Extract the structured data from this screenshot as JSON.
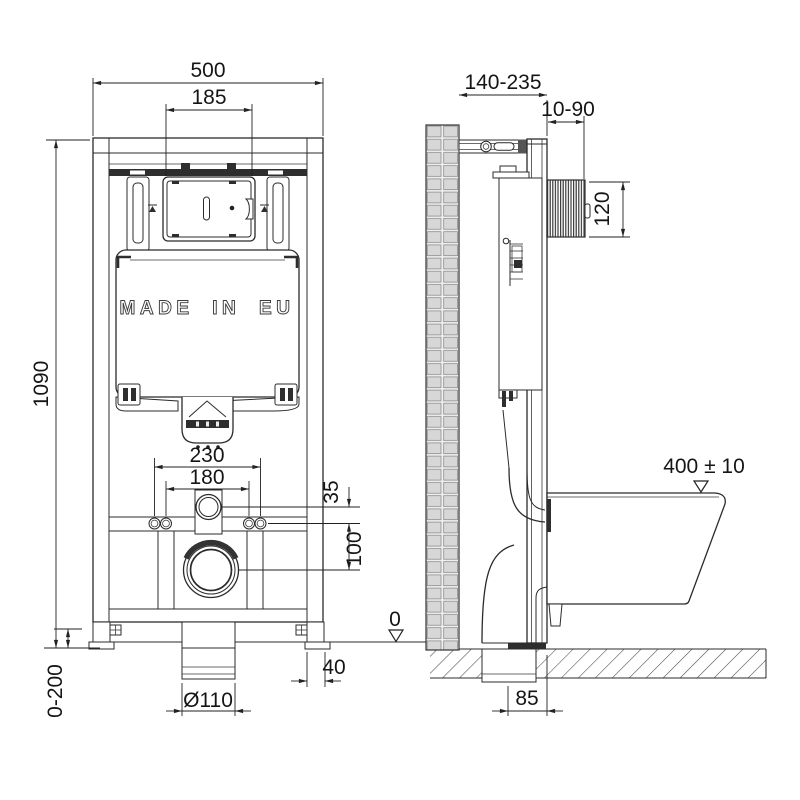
{
  "front_view": {
    "frame_width": "500",
    "cutout_width": "185",
    "frame_height": "1090",
    "fixing_spacing_outer": "230",
    "fixing_spacing_inner": "180",
    "inlet_offset": "35",
    "inlet_to_outlet": "100",
    "foot_width": "40",
    "foot_adjust_range": "0-200",
    "outlet_diameter": "Ø110",
    "made_in_label": "MADE IN EU"
  },
  "side_view": {
    "frame_depth_range": "140-235",
    "actuator_depth_range": "10-90",
    "actuator_height": "120",
    "bowl_top_height": "400 ± 10",
    "floor_datum": "0",
    "outlet_to_front": "85"
  }
}
